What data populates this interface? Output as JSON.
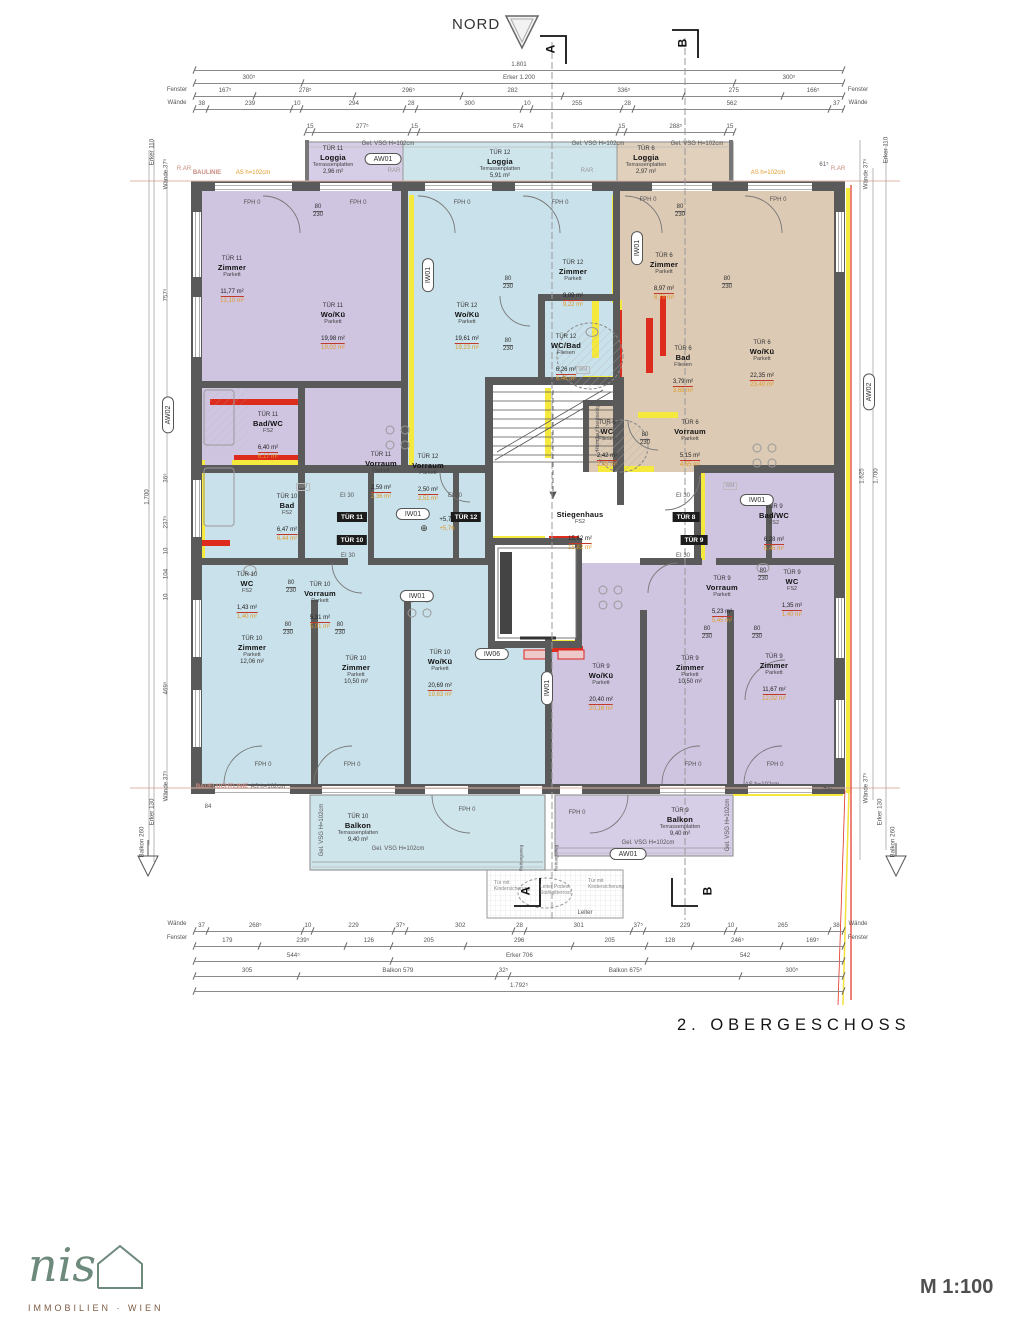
{
  "meta": {
    "title": "2. OBERGESCHOSS",
    "scale": "M 1:100",
    "north": "NORD",
    "sa": "A",
    "sb": "B"
  },
  "logo": {
    "script": "nis",
    "sub": "IMMOBILIEN · WIEN"
  },
  "ann": {
    "gel": "Gel. VSG H=102cm",
    "as": "AS h=102cm",
    "rar": "R.AR",
    "rar2": "RAR",
    "baulinie": "BAULINIE",
    "baufluchtlinie": "BAUFLUCHTLINIE",
    "fph": "FPH 0",
    "ei30": "EI 30",
    "wm": "WM",
    "handlauf": "Handlauf beidseitig",
    "rettungsweg": "Rettungsweg",
    "kinder": "Tür mit Kindersicherung",
    "leiter_podest": "Leiter Podest Stahlgitterrost",
    "leiter": "Leiter",
    "lvl_a": "+5,77",
    "lvl_b": "+5,76",
    "fenster": "Fenster",
    "waende": "Wände",
    "erker": "Erker",
    "balkon": "Balkon",
    "d61": "61⁵",
    "d74": "74⁵",
    "d84": "84"
  },
  "tags": {
    "t11": "TÜR 11",
    "t10": "TÜR 10",
    "t12": "TÜR 12",
    "t8": "TÜR 8",
    "t9": "TÜR 9"
  },
  "ovals": {
    "aw01": "AW01",
    "aw02": "AW02",
    "iw01": "IW01",
    "iw06": "IW06"
  },
  "door": {
    "w": "80",
    "h": "230"
  },
  "dims": {
    "top": [
      [
        "1.801"
      ],
      [
        "300⁵",
        "Erker 1.200",
        "300⁵"
      ],
      [
        "167⁵",
        "278⁵",
        "296⁵",
        "282",
        "336⁵",
        "275",
        "166⁵"
      ],
      [
        "38",
        "239",
        "10",
        "294",
        "28",
        "300",
        "10",
        "255",
        "28",
        "562",
        "37"
      ],
      [
        "15",
        "277⁵",
        "15",
        "574",
        "15",
        "288⁵",
        "15"
      ]
    ],
    "bottom": [
      [
        "37",
        "268⁵",
        "10",
        "229",
        "37⁵",
        "302",
        "28",
        "301",
        "37⁵",
        "229",
        "10",
        "265",
        "38"
      ],
      [
        "179",
        "239⁵",
        "126",
        "205",
        "296",
        "205",
        "128",
        "246⁵",
        "169⁵"
      ],
      [
        "544⁵",
        "Erker 706",
        "542"
      ],
      [
        "305",
        "Balkon 579",
        "32⁵",
        "Balkon 675⁵",
        "300⁵"
      ],
      [
        "1.792⁵"
      ]
    ],
    "left": [
      "Erker 110",
      "Wände 37⁵",
      "757⁵",
      "36⁵",
      "237⁵",
      "10",
      "104",
      "10",
      "469⁵",
      "Wände 37⁵",
      "Erker 130",
      "Balkon 260",
      "1.700"
    ],
    "right": [
      "Erker 110",
      "Wände 37⁵",
      "1.625",
      "1.700",
      "Wände 37⁵",
      "Erker 130",
      "Balkon 260"
    ]
  },
  "rooms": [
    {
      "tur": "TÜR 11",
      "name": "Loggia",
      "finish": "Terrassenplatten",
      "area": "2,96 m²"
    },
    {
      "tur": "TÜR 12",
      "name": "Loggia",
      "finish": "Terrassenplatten",
      "area": "5,91 m²"
    },
    {
      "tur": "TÜR 6",
      "name": "Loggia",
      "finish": "Terrassenplatten",
      "area": "2,97 m²"
    },
    {
      "tur": "TÜR 11",
      "name": "Zimmer",
      "finish": "Parkett",
      "area": "11,77 m²",
      "area2": "12,10 m²"
    },
    {
      "tur": "TÜR 11",
      "name": "Wo/Kü",
      "finish": "Parkett",
      "area": "19,98 m²",
      "area2": "19,02 m²"
    },
    {
      "tur": "TÜR 12",
      "name": "Wo/Kü",
      "finish": "Parkett",
      "area": "19,61 m²",
      "area2": "19,23 m²"
    },
    {
      "tur": "TÜR 12",
      "name": "Zimmer",
      "finish": "Parkett",
      "area": "9,09 m²",
      "area2": "9,22 m²"
    },
    {
      "tur": "TÜR 12",
      "name": "WC/Bad",
      "finish": "Fliesen",
      "area": "6,26 m²",
      "area2": "6,46 m²"
    },
    {
      "tur": "TÜR 6",
      "name": "Zimmer",
      "finish": "Parkett",
      "area": "8,97 m²",
      "area2": "8,78 m²"
    },
    {
      "tur": "TÜR 6",
      "name": "Bad",
      "finish": "Fliesen",
      "area": "3,79 m²",
      "area2": "3,65 m²"
    },
    {
      "tur": "TÜR 6",
      "name": "Wo/Kü",
      "finish": "Parkett",
      "area": "22,35 m²",
      "area2": "23,40 m²"
    },
    {
      "tur": "TÜR 6",
      "name": "WC",
      "finish": "Fliesen",
      "area": "2,42 m²",
      "area2": "2,43 m²"
    },
    {
      "tur": "TÜR 6",
      "name": "Vorraum",
      "finish": "Parkett",
      "area": "5,15 m²",
      "area2": "4,55 m²"
    },
    {
      "tur": "TÜR 11",
      "name": "Bad/WC",
      "finish": "FS2",
      "area": "6,40 m²",
      "area2": "6,17 m²"
    },
    {
      "tur": "TÜR 11",
      "name": "Vorraum",
      "finish": "Parkett",
      "area": "2,59 m²",
      "area2": "2,36 m²"
    },
    {
      "tur": "TÜR 12",
      "name": "Vorraum",
      "finish": "Parkett",
      "area": "2,50 m²",
      "area2": "2,51 m²"
    },
    {
      "tur": "TÜR 10",
      "name": "Bad",
      "finish": "FS2",
      "area": "6,47 m²",
      "area2": "6,44 m²"
    },
    {
      "tur": "TÜR 10",
      "name": "WC",
      "finish": "FS2",
      "area": "1,43 m²",
      "area2": "1,40 m²"
    },
    {
      "tur": "TÜR 10",
      "name": "Vorraum",
      "finish": "Parkett",
      "area": "5,31 m²",
      "area2": "5,01 m²"
    },
    {
      "tur": "TÜR 9",
      "name": "Bad/WC",
      "finish": "FS2",
      "area": "6,28 m²",
      "area2": "6,45 m²"
    },
    {
      "tur": "TÜR 9",
      "name": "WC",
      "finish": "FS2",
      "area": "1,35 m²",
      "area2": "1,40 m²"
    },
    {
      "tur": "TÜR 9",
      "name": "Vorraum",
      "finish": "Parkett",
      "area": "5,23 m²",
      "area2": "5,45 m²"
    },
    {
      "tur": "",
      "name": "Stiegenhaus",
      "finish": "FS2",
      "area": "15,62 m²",
      "area2": "15,82 m²"
    },
    {
      "tur": "TÜR 10",
      "name": "Zimmer",
      "finish": "Parkett",
      "area": "12,06 m²"
    },
    {
      "tur": "TÜR 10",
      "name": "Zimmer",
      "finish": "Parkett",
      "area": "10,50 m²"
    },
    {
      "tur": "TÜR 10",
      "name": "Wo/Kü",
      "finish": "Parkett",
      "area": "20,69 m²",
      "area2": "19,83 m²"
    },
    {
      "tur": "TÜR 9",
      "name": "Wo/Kü",
      "finish": "Parkett",
      "area": "20,40 m²",
      "area2": "20,16 m²"
    },
    {
      "tur": "TÜR 9",
      "name": "Zimmer",
      "finish": "Parkett",
      "area": "10,50 m²"
    },
    {
      "tur": "TÜR 9",
      "name": "Zimmer",
      "finish": "Parkett",
      "area": "11,67 m²",
      "area2": "12,02 m²"
    },
    {
      "tur": "TÜR 10",
      "name": "Balkon",
      "finish": "Terrassenplatten",
      "area": "9,40 m²"
    },
    {
      "tur": "TÜR 9",
      "name": "Balkon",
      "finish": "Terrassenplatten",
      "area": "9,40 m²"
    }
  ],
  "colors": {
    "purple": "#cfc5e1",
    "blue": "#c9e1ea",
    "tan": "#dccab4",
    "wall": "#5a5a5a",
    "red": "#dd2b1e",
    "yellow": "#f6e93e",
    "orange": "#e09a28"
  }
}
